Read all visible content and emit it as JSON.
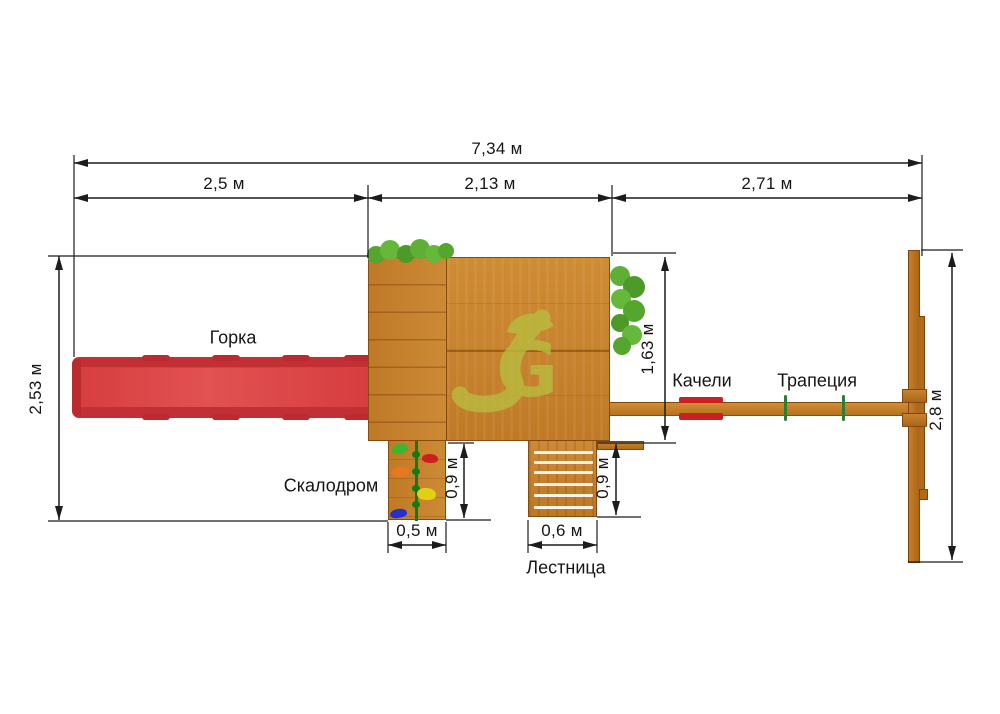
{
  "title": "Схема детской площадки — вид сверху",
  "dims": {
    "total": "7,34 м",
    "slide_w": "2,5 м",
    "platform_w": "2,13 м",
    "swing_w": "2,71 м",
    "left_d": "2,53 м",
    "platform_d": "1,63 м",
    "right_d": "2,8 м",
    "climb_d": "0,9 м",
    "climb_w": "0,5 м",
    "ladder_d": "0,9 м",
    "ladder_w": "0,6 м"
  },
  "labels": {
    "slide": "Горка",
    "climb": "Скалодром",
    "ladder": "Лестница",
    "swing": "Качели",
    "trapeze": "Трапеция"
  },
  "watermark": {
    "letter": "G"
  },
  "colors": {
    "line_black": "#1c1c1c",
    "wood": "#c5812d",
    "wood_dark": "#a96518",
    "slide_red": "#d94040",
    "slide_rim": "#c22f34",
    "bush_green": "#5aa832",
    "hold_green": "#3cb52f",
    "hold_red": "#cc1f1f",
    "hold_orange": "#e87820",
    "hold_yellow": "#e3cf14",
    "hold_blue": "#2330cc",
    "rope_green": "#157a15",
    "trapeze_green": "#2e7d32",
    "watermark_olive": "#b9bc3f"
  }
}
